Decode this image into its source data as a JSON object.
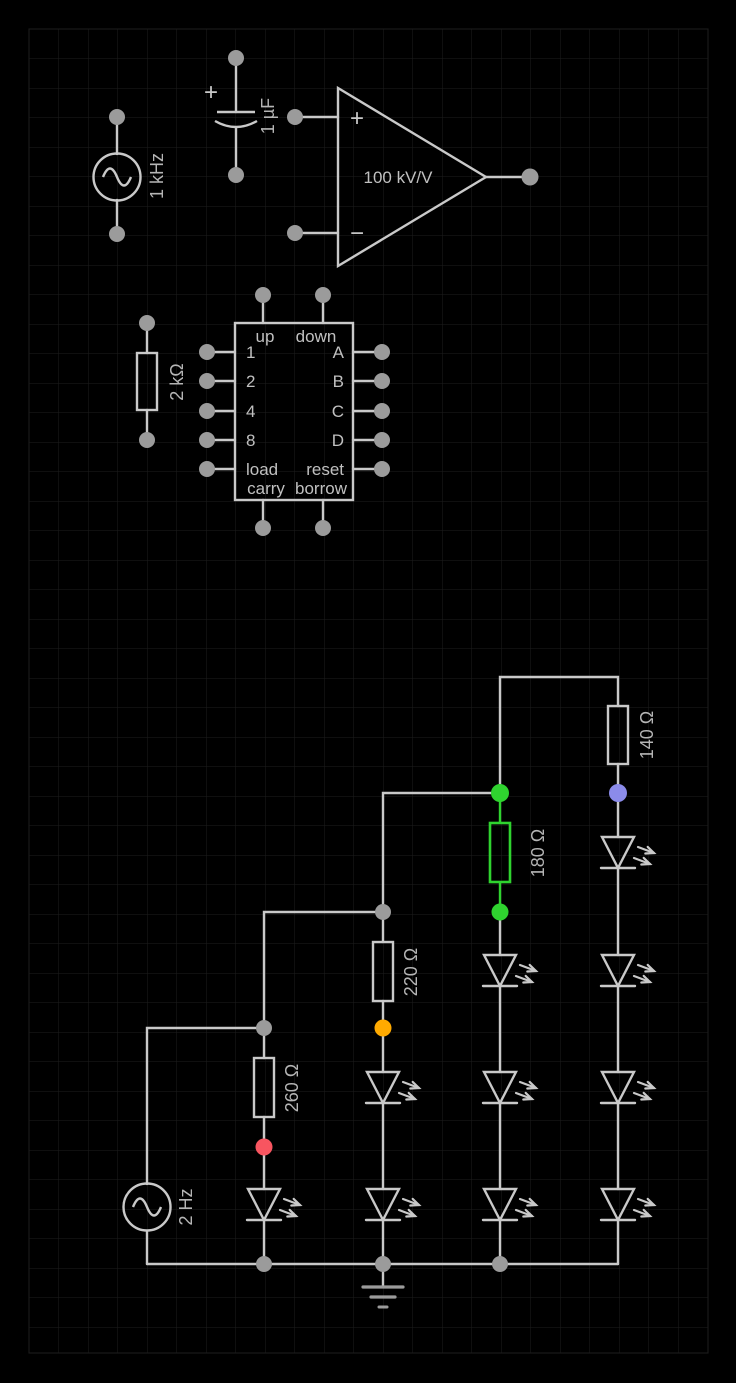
{
  "app": {
    "name": "circuit-simulator-canvas"
  },
  "canvas": {
    "background": "#000000",
    "grid_color": "#1e1e1e",
    "grid_cell_px": 29.5,
    "wire_color": "#c9c9c9",
    "text_color": "#b5b5b5",
    "terminal_color": "#9b9b9b"
  },
  "components": {
    "ac_source_1khz": {
      "kind": "ac-voltage-source",
      "label": "1 kHz"
    },
    "capacitor_1uf": {
      "kind": "polarized-capacitor",
      "label": "1 µF",
      "polarity_mark": "+"
    },
    "opamp": {
      "kind": "op-amp",
      "gain_label": "100 kV/V",
      "noninverting_mark": "+",
      "inverting_mark": "−"
    },
    "counter_ic": {
      "kind": "up-down-counter-ic",
      "pin_up": "up",
      "pin_down": "down",
      "pins_left": [
        "1",
        "2",
        "4",
        "8",
        "load"
      ],
      "pins_right": [
        "A",
        "B",
        "C",
        "D",
        "reset"
      ],
      "pin_carry": "carry",
      "pin_borrow": "borrow"
    },
    "resistor_2k": {
      "kind": "resistor",
      "label": "2 kΩ"
    },
    "resistor_140": {
      "kind": "resistor",
      "label": "140 Ω"
    },
    "resistor_180": {
      "kind": "resistor",
      "label": "180 Ω",
      "highlight_color": "#2fd32f"
    },
    "resistor_220": {
      "kind": "resistor",
      "label": "220 Ω"
    },
    "resistor_260": {
      "kind": "resistor",
      "label": "260 Ω"
    },
    "ac_source_2hz": {
      "kind": "ac-voltage-source",
      "label": "2 Hz"
    },
    "leds": {
      "kind": "led",
      "count": 10
    },
    "ground": {
      "kind": "ground"
    }
  },
  "node_indicators": {
    "green": "#2fd32f",
    "blue": "#8b8bea",
    "orange": "#ffaa00",
    "red": "#f85560",
    "junction_gray": "#9b9b9b"
  }
}
